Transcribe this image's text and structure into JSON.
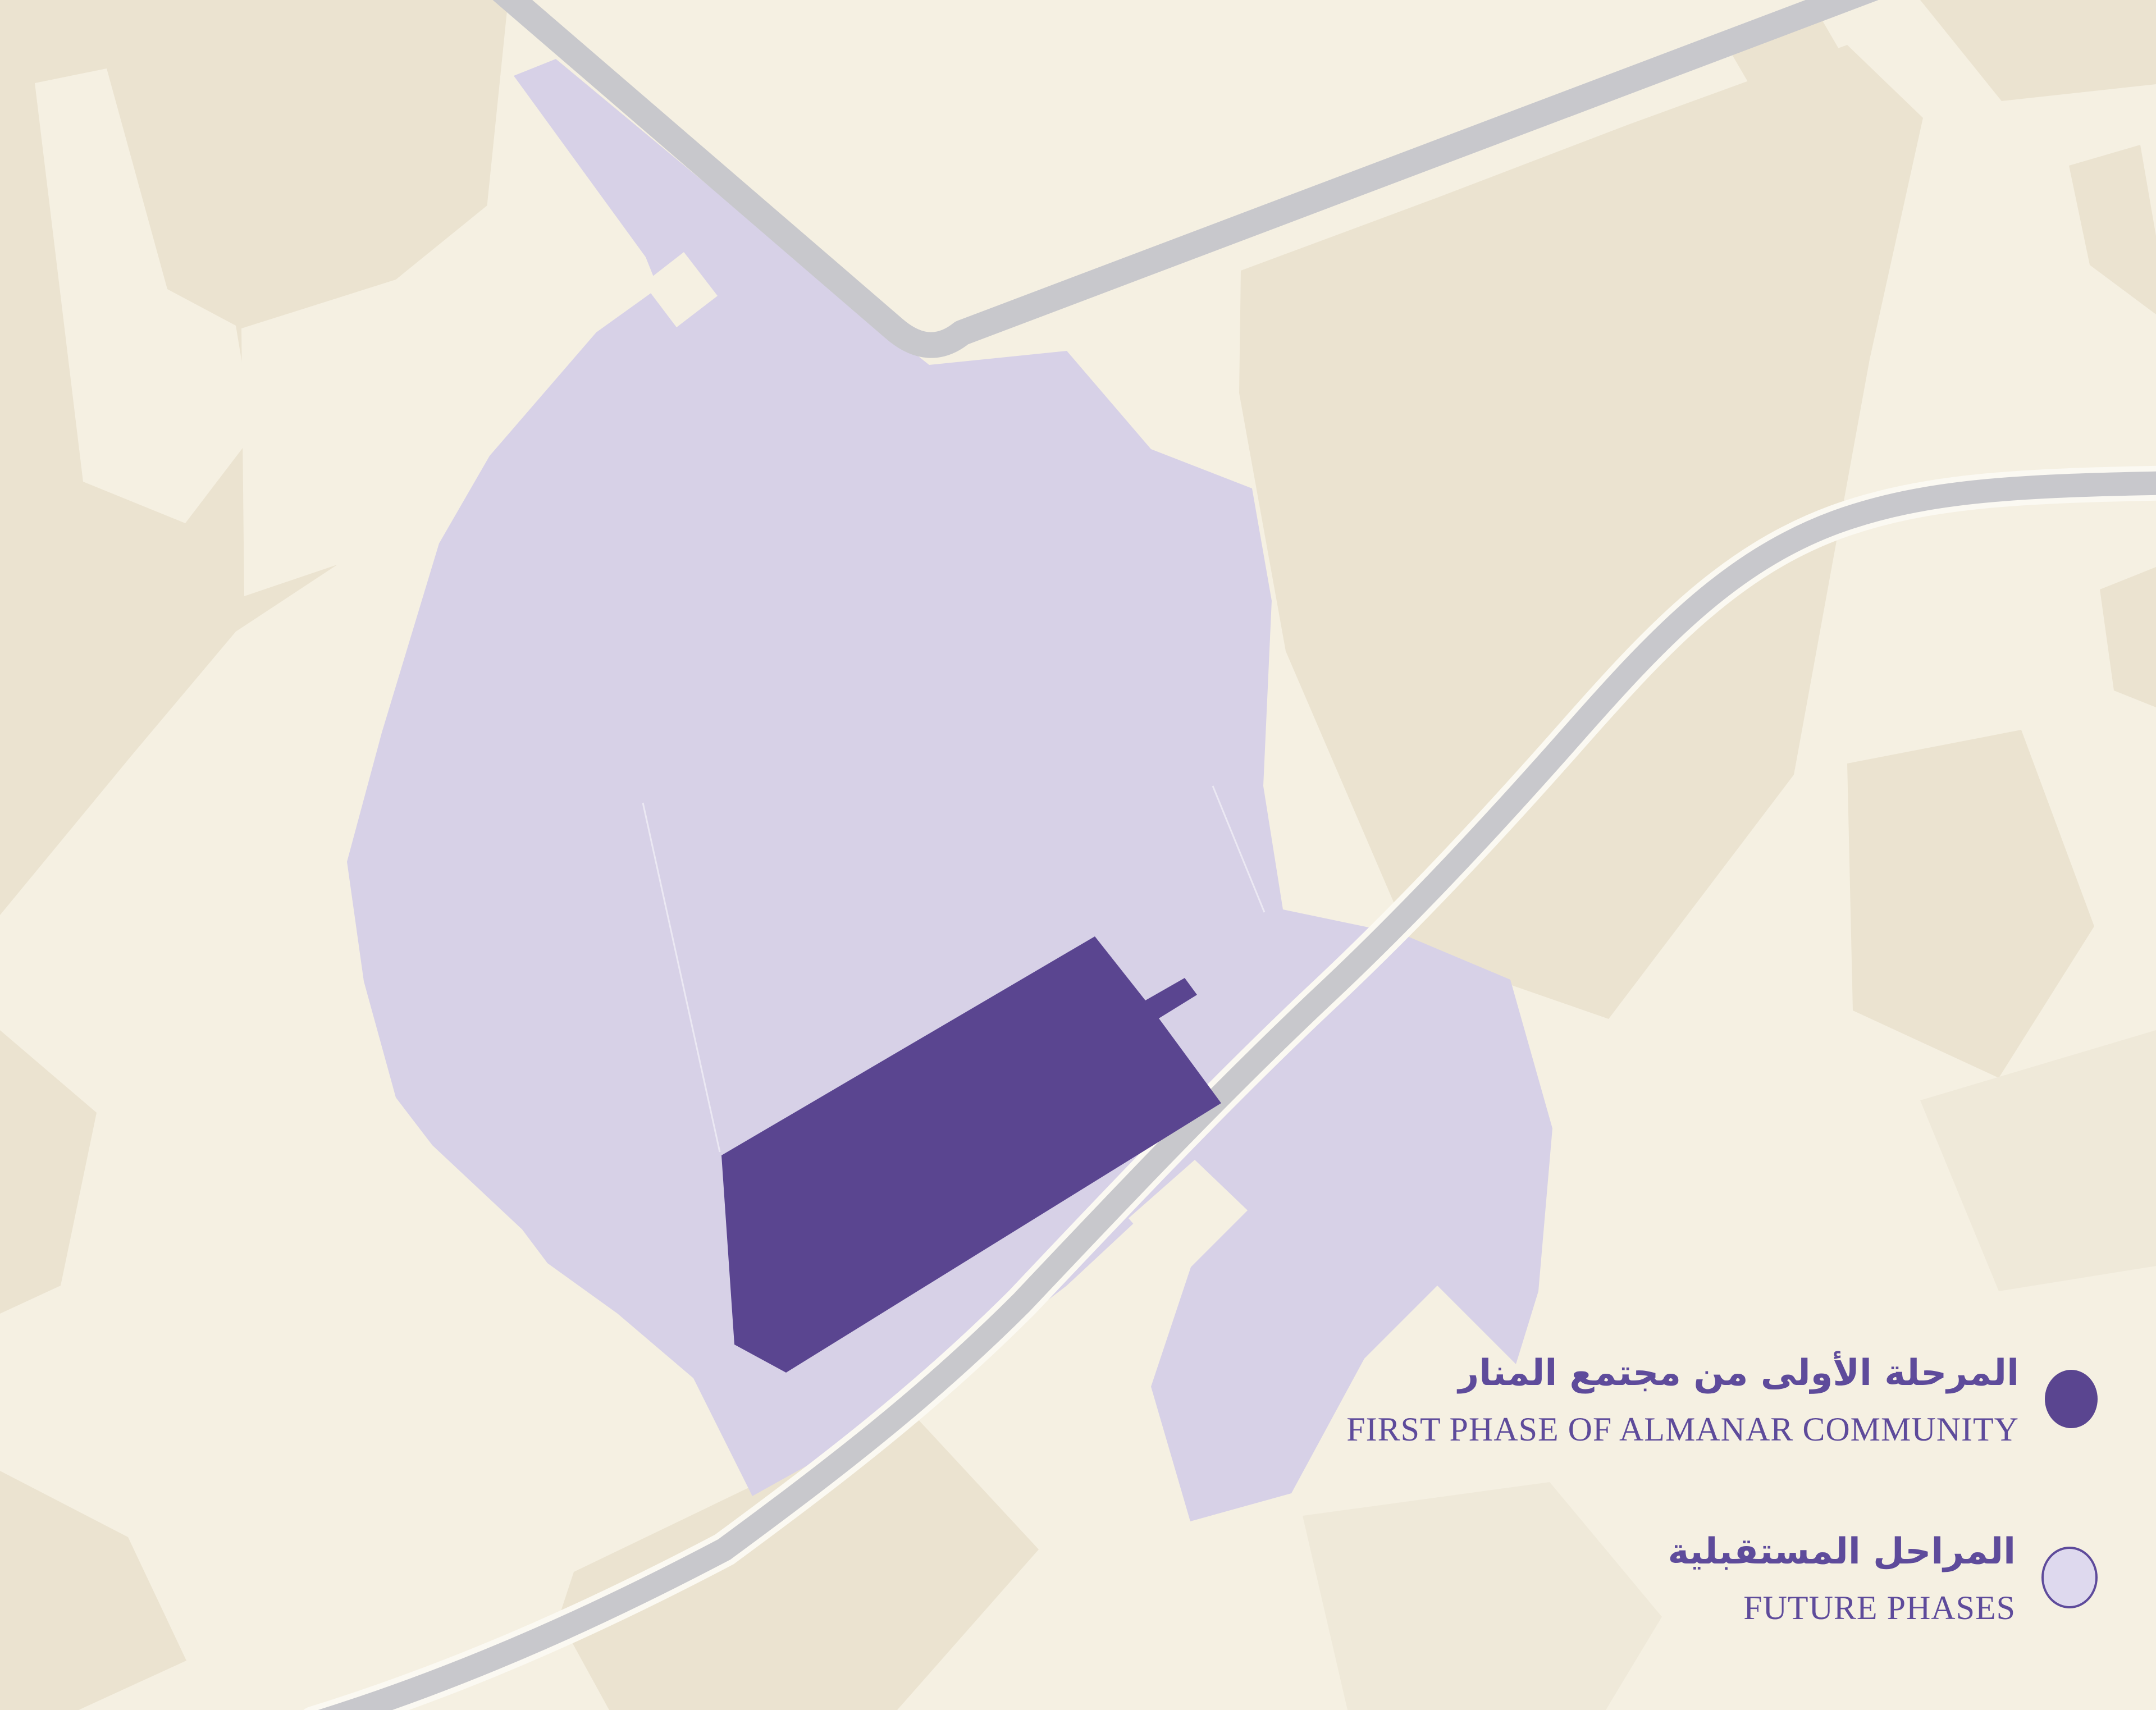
{
  "legend": {
    "items": [
      {
        "id": "first-phase",
        "label_ar": "المرحلة الأولى من مجتمع المنار",
        "label_en": "FIRST PHASE OF ALMANAR COMMUNITY",
        "swatch_color": "#5a4590"
      },
      {
        "id": "future-phases",
        "label_ar": "المراحل المستقبلية",
        "label_en": "FUTURE PHASES",
        "swatch_color": "#ded9ee",
        "swatch_outline_color": "#5e4b9b"
      }
    ]
  },
  "map": {
    "areas": [
      {
        "name": "first-phase-area",
        "color": "#5a4590"
      },
      {
        "name": "future-phases-area",
        "color": "#d7d1e7"
      }
    ],
    "background_color": "#f5f0e2",
    "parcel_patch_color": "#ebe3d0",
    "road_color": "#c8c8cc",
    "road_casing_color": "#fbf9f2",
    "legend_text_color": "#5e4b9b"
  }
}
